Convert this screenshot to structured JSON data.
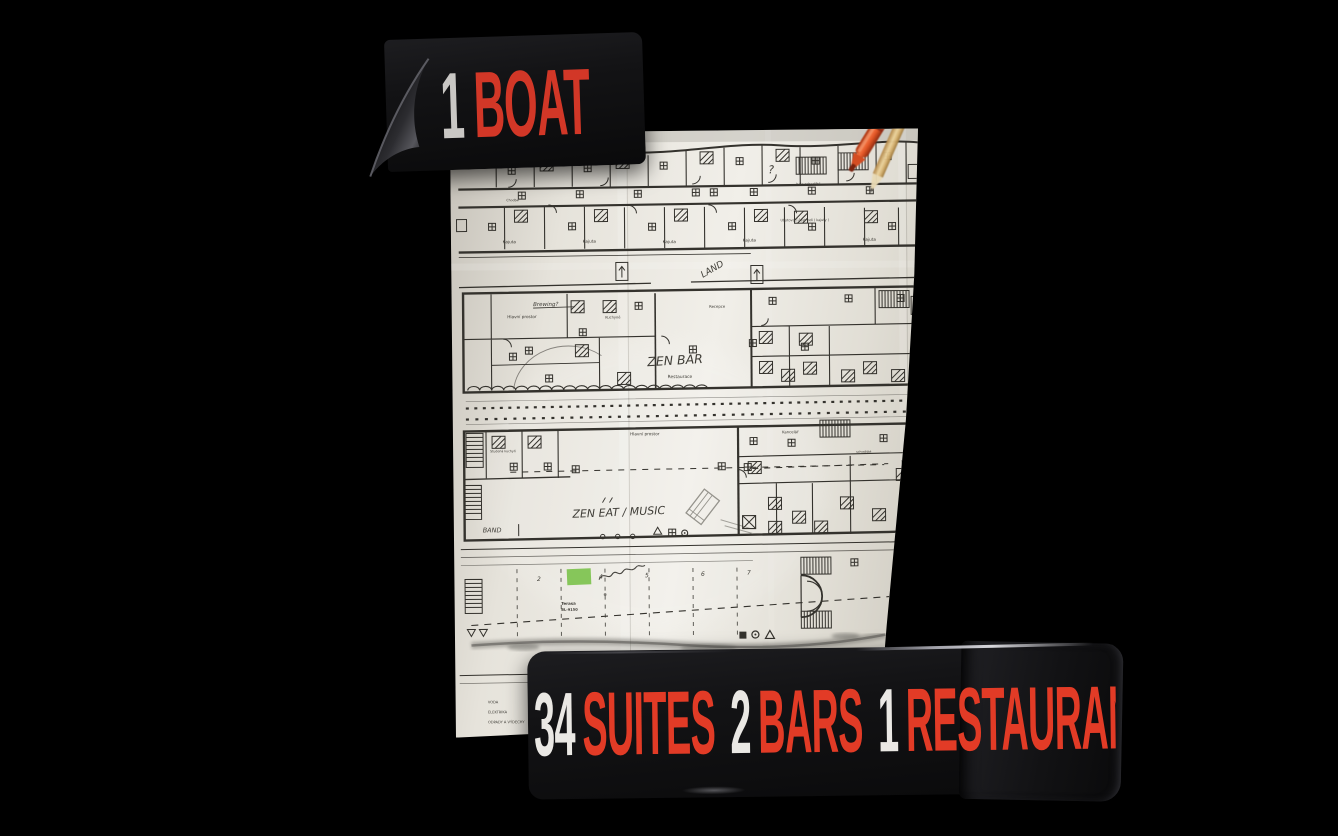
{
  "colors": {
    "background": "#000000",
    "banner_black": "#131315",
    "headline_red": "#d9381f",
    "headline_white": "#e9e7e3",
    "paper": "#ece9e2",
    "ink": "#34322d",
    "highlight_green": "#7ac24a",
    "pen_orange": "#e8572a",
    "pencil_wood": "#d9b876"
  },
  "top_banner": {
    "number": "1",
    "word": "BOAT"
  },
  "bottom_banner": {
    "segments": [
      {
        "number": "34",
        "word": "SUITES"
      },
      {
        "number": "2",
        "word": "BARS"
      },
      {
        "number": "1",
        "word": "RESTAURANT"
      }
    ]
  },
  "floor_plan": {
    "handwritten": {
      "brewing": "Brewing?",
      "zen_bar": "ZEN BAR",
      "zen_eat": "ZEN EAT / MUSIC",
      "band": "BAND",
      "land": "LAND",
      "question": "?",
      "cols": [
        "2",
        "4",
        "5",
        "6",
        "7"
      ]
    },
    "printed": {
      "kajuta": "Kajuta",
      "chodba": "Chodba",
      "restaurace": "Restaurace",
      "hlavni_prostor": "Hlavní prostor",
      "kuchyne": "Kuchyně",
      "studena": "Studená kuchyň",
      "recepce": "Recepce",
      "kancelar": "Kancelář",
      "schodiste": "schodiště",
      "hala_schodiste": "hala schodiště",
      "ubytovaci": "Ubytovací část lodi ( kajuty )",
      "terasa": "Terasa",
      "terasa_code": "BL-9150"
    },
    "legend": [
      {
        "label": "VODA",
        "detail": "( 5° - ventil a rychl. )"
      },
      {
        "label": "ELEKTRIKA",
        "detail": "( 3x 32, 1x 75 )"
      },
      {
        "label": "ODPADY A VÝDECHY",
        "detail": "( 3x potopní, 3x suché )"
      }
    ]
  }
}
